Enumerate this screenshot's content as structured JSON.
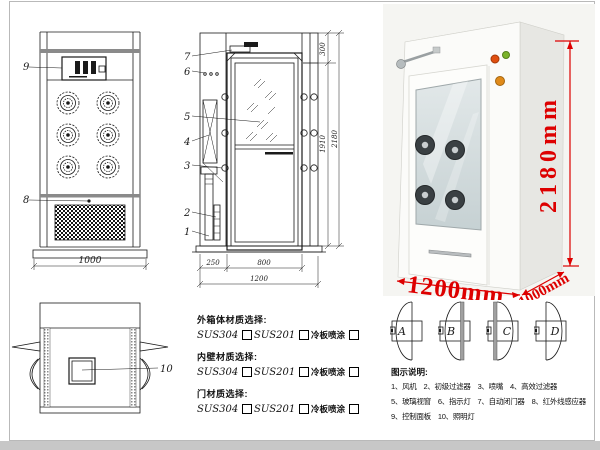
{
  "front_view": {
    "callout_control_panel": "9",
    "callout_grille": "8",
    "dim_width": "1000"
  },
  "side_view": {
    "callouts": {
      "c7": "7",
      "c6": "6",
      "c5": "5",
      "c4": "4",
      "c3": "3",
      "c2": "2",
      "c1": "1"
    },
    "dims": {
      "top": "300",
      "inner": "1910",
      "total": "2180",
      "left": "250",
      "door": "800",
      "overall": "1200"
    }
  },
  "top_view": {
    "callout_lamp": "10"
  },
  "photo": {
    "dims": {
      "height": "2180mm",
      "width": "1200mm",
      "depth": "1000mm"
    },
    "dim_color": "#dd0000"
  },
  "materials": {
    "sections": [
      {
        "label": "外箱体材质选择:",
        "options": [
          "SUS304",
          "SUS201",
          "冷板喷涂"
        ]
      },
      {
        "label": "内壁材质选择:",
        "options": [
          "SUS304",
          "SUS201",
          "冷板喷涂"
        ]
      },
      {
        "label": "门材质选择:",
        "options": [
          "SUS304",
          "SUS201",
          "冷板喷涂"
        ]
      }
    ]
  },
  "door_configs": {
    "labels": [
      "A",
      "B",
      "C",
      "D"
    ]
  },
  "legend": {
    "title": "图示说明:",
    "items": [
      "1、风机",
      "2、初级过滤器",
      "3、喷嘴",
      "4、高效过滤器",
      "5、玻璃视窗",
      "6、指示灯",
      "7、自动闭门器",
      "8、红外线感应器",
      "9、控制面板",
      "10、照明灯"
    ]
  },
  "colors": {
    "drawing": "#1a1a1a",
    "dimension_red": "#dd0000",
    "frame_gray": "#c7c7c7"
  }
}
